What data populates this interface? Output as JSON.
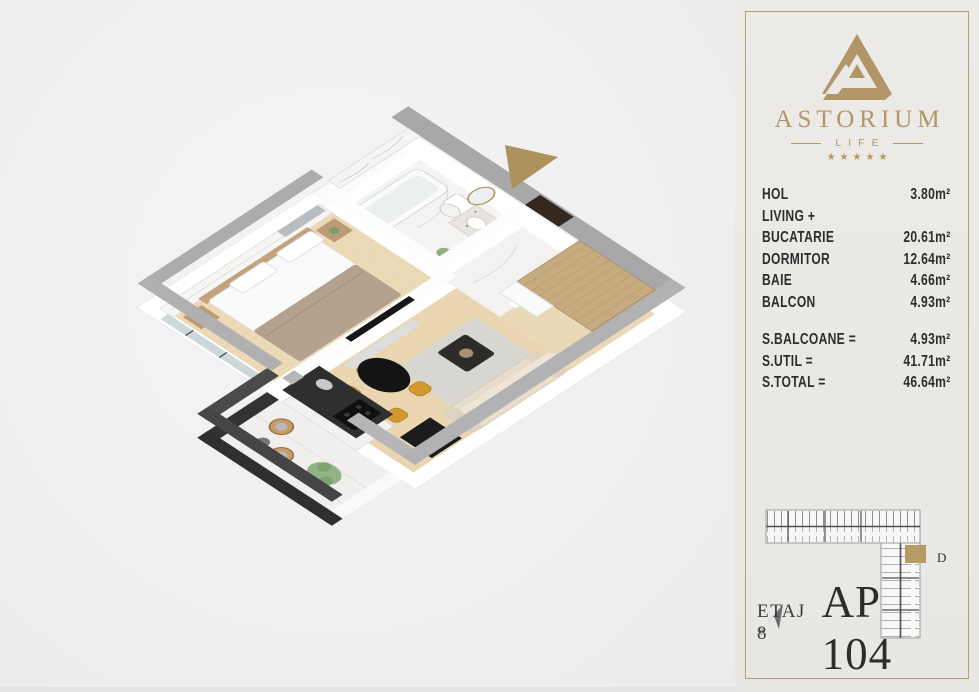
{
  "page": {
    "background": "#f0f0f1"
  },
  "floorplan": {
    "entrance_arrow_color": "#ad925c",
    "colors": {
      "outer_wall_top": "#a8a8aa",
      "inner_wall": "#ffffff",
      "wood_floor": "#ecd9b5",
      "marble_floor": "#f5f4f2",
      "balcony_wall": "#38383a",
      "wardrobe_wood": "#c6aa80",
      "entrance_door": "#332921",
      "dining_chair": "#d2992f",
      "sofa": "#e6ddcc"
    }
  },
  "panel": {
    "background": "#ebe9e6",
    "border_color": "#b49d72",
    "text_color": "#2d2d2d",
    "logo": {
      "brand": "ASTORIUM",
      "subtitle": "LIFE",
      "stars": "★★★★★",
      "color": "#b29668"
    },
    "rooms": [
      {
        "label": "HOL",
        "value": "3.80m²"
      },
      {
        "label": "LIVING +",
        "value": ""
      },
      {
        "label": "BUCATARIE",
        "value": "20.61m²"
      },
      {
        "label": "DORMITOR",
        "value": "12.64m²"
      },
      {
        "label": "BAIE",
        "value": "4.66m²"
      },
      {
        "label": "BALCON",
        "value": "4.93m²"
      }
    ],
    "totals": [
      {
        "label": "S.BALCOANE =",
        "value": "4.93m²"
      },
      {
        "label": "S.UTIL =",
        "value": "41.71m²"
      },
      {
        "label": "S.TOTAL =",
        "value": "46.64m²"
      }
    ],
    "minimap": {
      "unit_label": "D",
      "highlight_color": "#b59c62",
      "compass_label": "N"
    },
    "floor_label": "ETAJ 8",
    "unit_label": "AP 104"
  }
}
